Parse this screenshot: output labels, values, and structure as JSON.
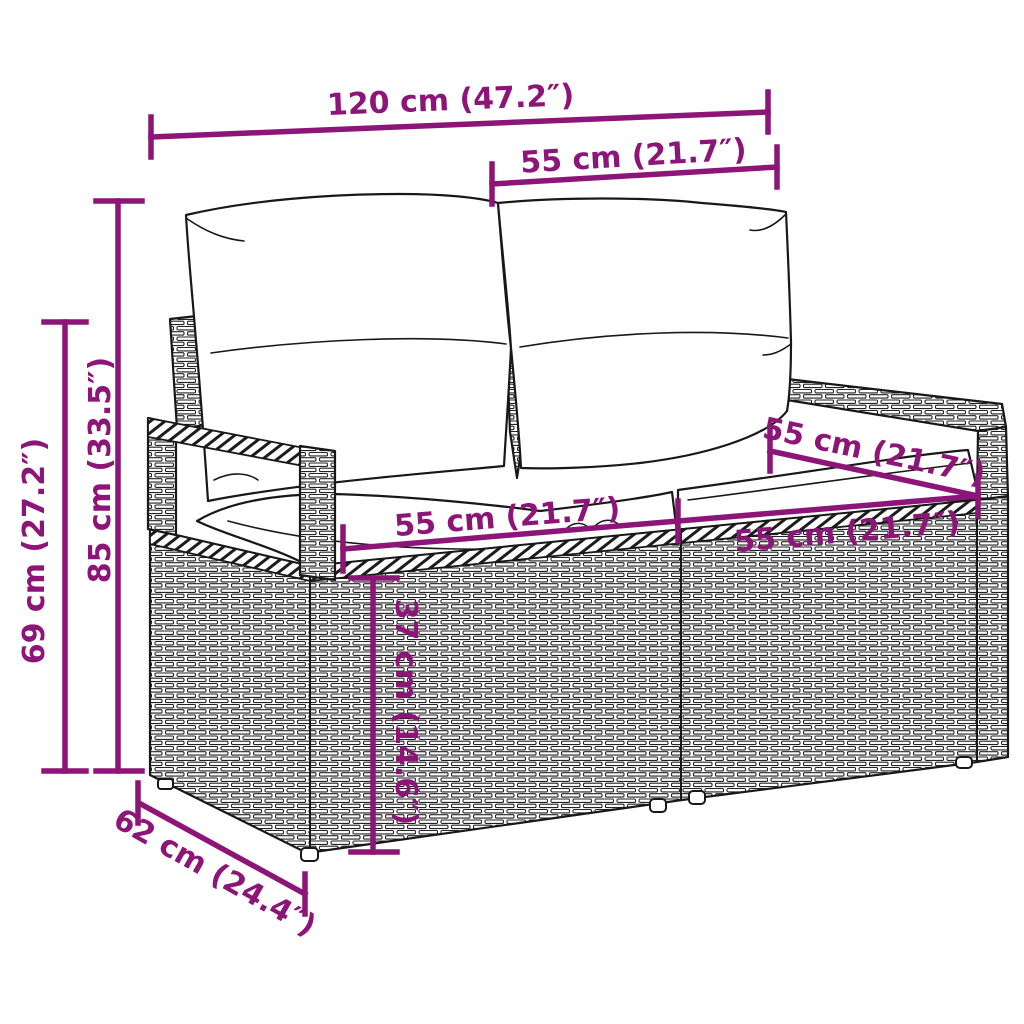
{
  "figure": {
    "subject": "rattan-garden-loveseat-line-art",
    "style": "black outline drawing with magenta dimension annotations on white background"
  },
  "colors": {
    "dimension_accent": "#8C1577",
    "line_art": "#181818",
    "background": "#FFFFFF"
  },
  "dimensions": {
    "total_width": "120 cm (47.2″)",
    "backrest_section_width": "55 cm (21.7″)",
    "total_height": "85 cm (33.5″)",
    "armrest_height": "69 cm (27.2″)",
    "seat_width_left": "55 cm (21.7″)",
    "seat_width_right": "55 cm (21.7″)",
    "armrest_top_depth": "55 cm (21.7″)",
    "seat_height": "37 cm (14.6″)",
    "depth": "62 cm (24.4″)"
  }
}
